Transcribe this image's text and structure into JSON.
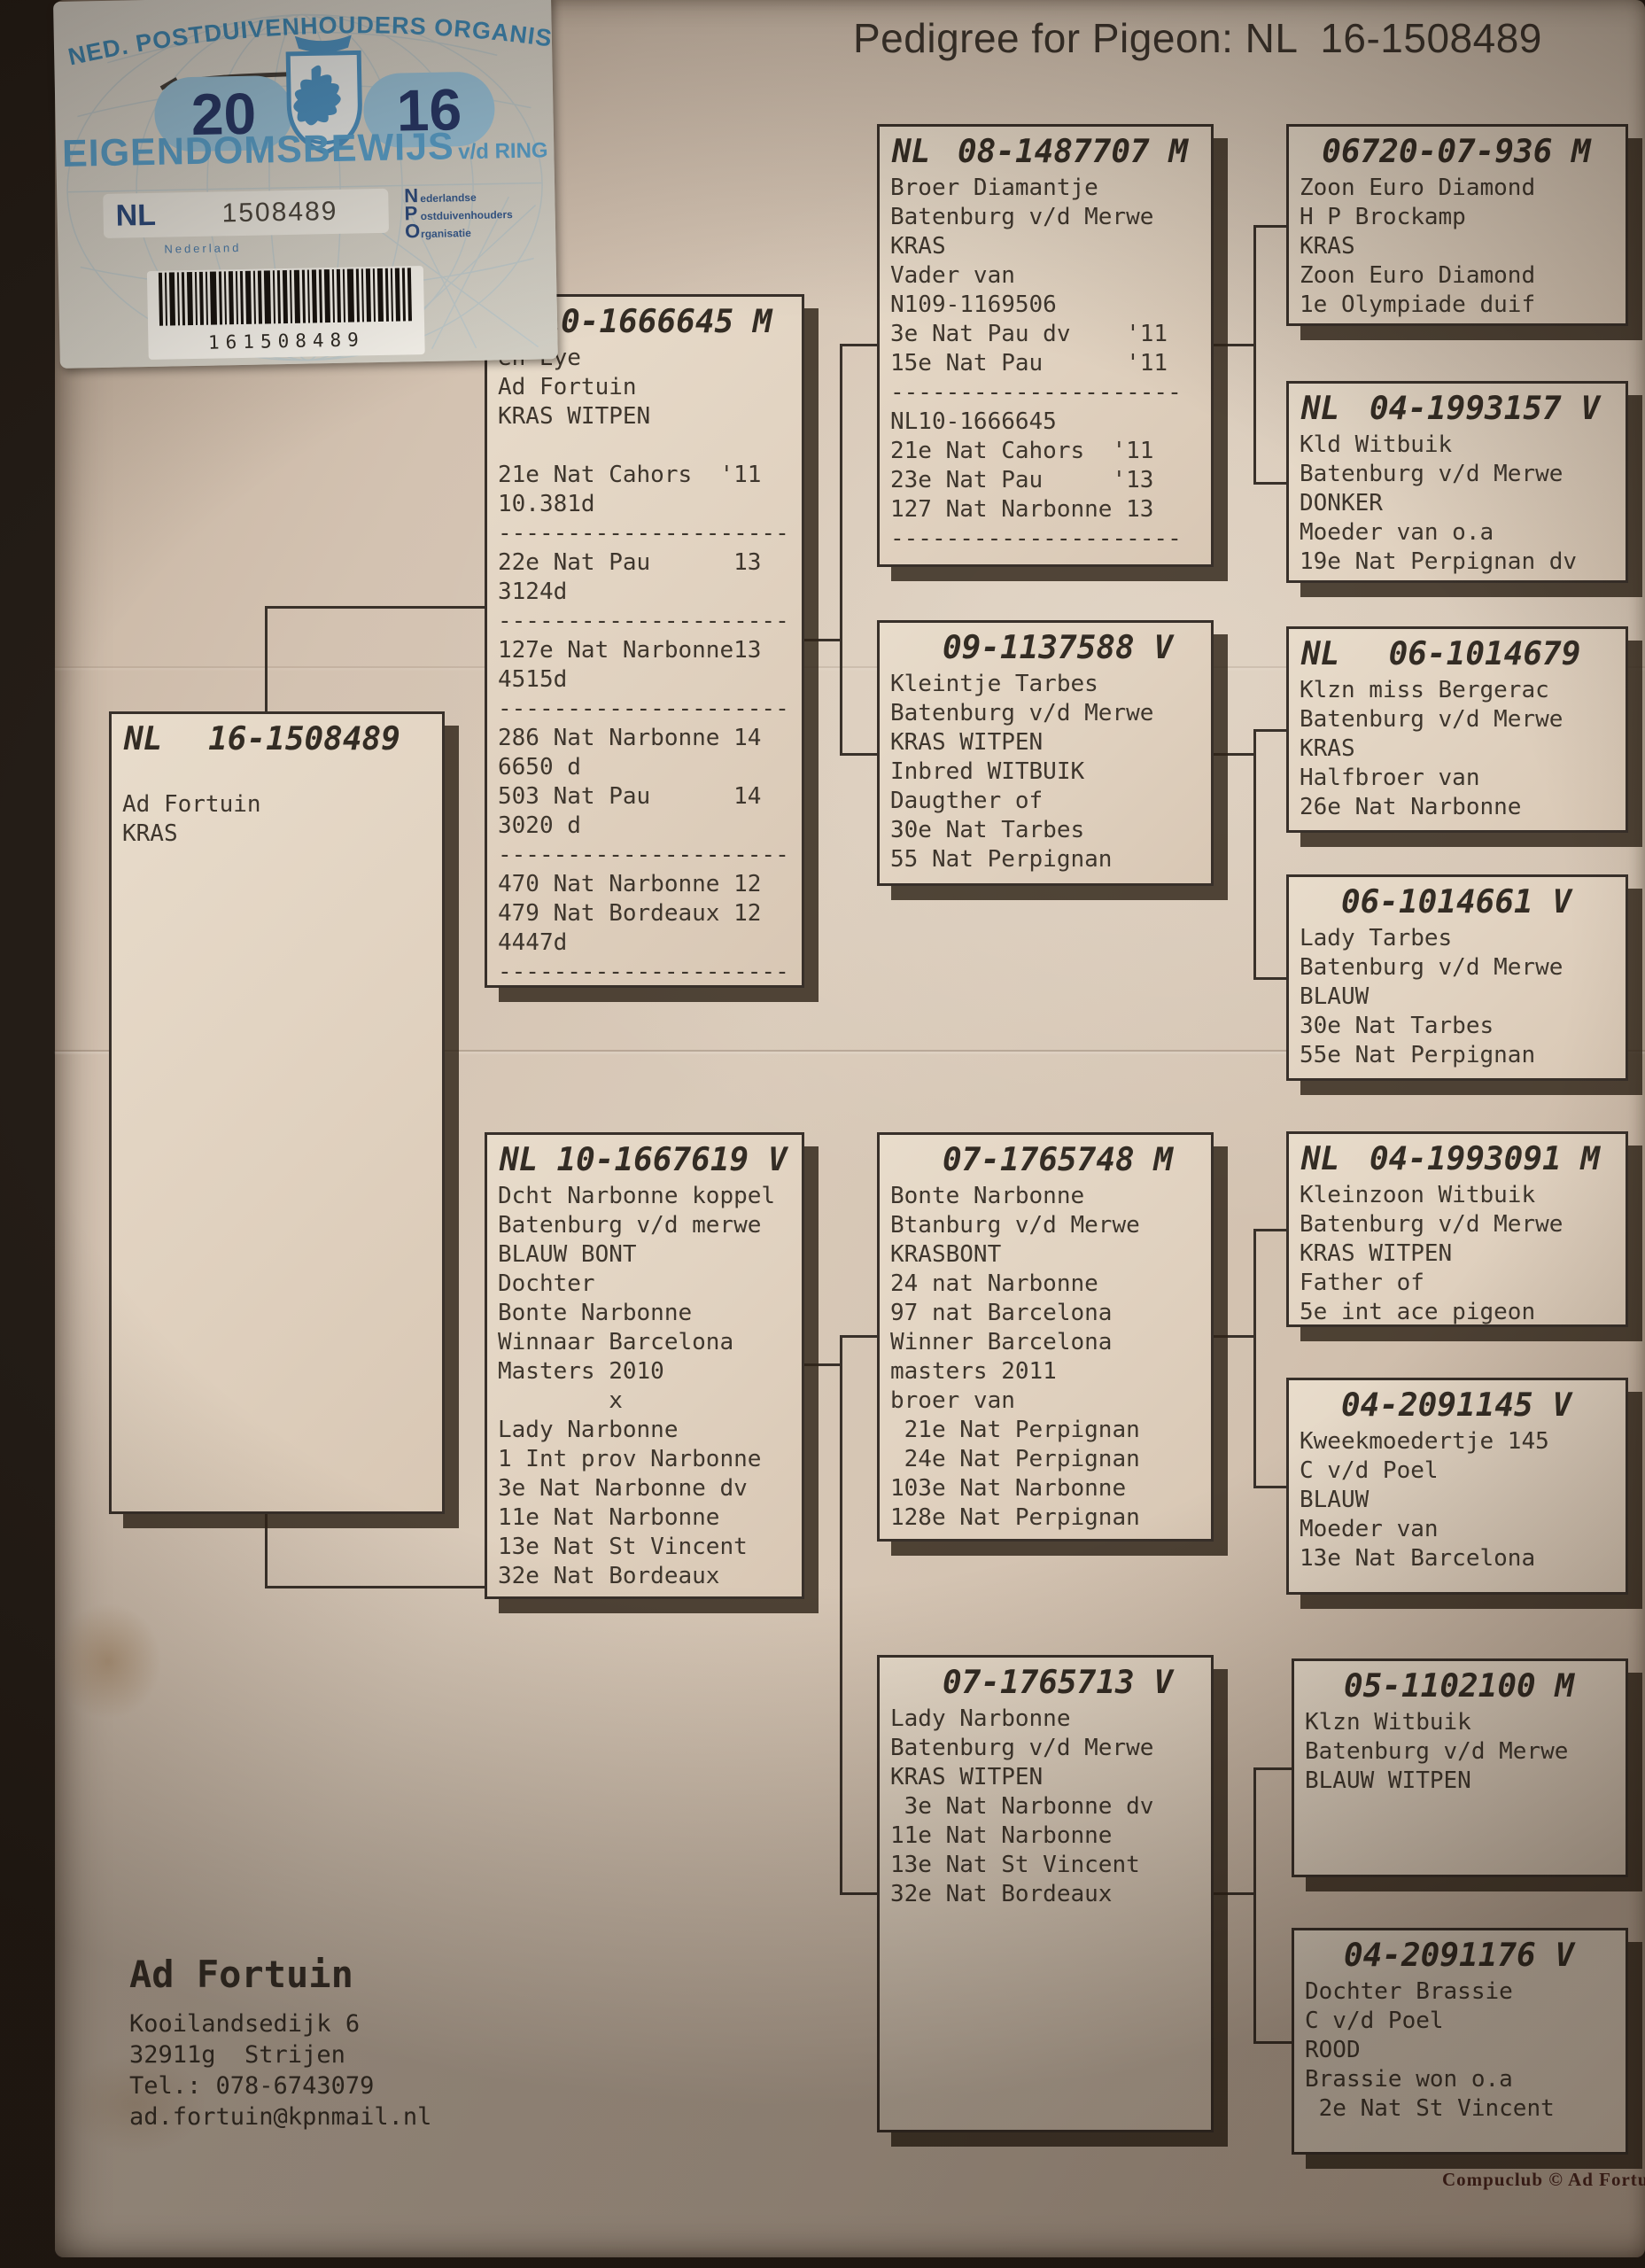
{
  "title": "Pedigree for Pigeon: NL  16-1508489",
  "sticker": {
    "org_arc": "NED. POSTDUIVENHOUDERS ORGANISATIE",
    "year_left": "20",
    "year_right": "16",
    "ownership_main": "EIGENDOMSBEWIJS",
    "ownership_suffix": "v/d RING",
    "country": "NL",
    "ring_number": "1508489",
    "npo_rows": [
      {
        "initial": "N",
        "rest": "ederlandse"
      },
      {
        "initial": "P",
        "rest": "ostduivenhouders"
      },
      {
        "initial": "O",
        "rest": "rganisatie"
      }
    ],
    "nederland_caption": "Nederland",
    "barcode_number": "161508489"
  },
  "pedigree": {
    "subject": {
      "prefix": "NL",
      "ring": "16-1508489",
      "body": "\nAd Fortuin\nKRAS"
    },
    "father": {
      "prefix": "",
      "ring": "10-1666645 M",
      "body": "en Eye\nAd Fortuin\nKRAS WITPEN\n\n21e Nat Cahors  '11\n10.381d\n---------------------\n22e Nat Pau      13\n3124d\n---------------------\n127e Nat Narbonne13\n4515d\n---------------------\n286 Nat Narbonne 14\n6650 d\n503 Nat Pau      14\n3020 d\n---------------------\n470 Nat Narbonne 12\n479 Nat Bordeaux 12\n4447d\n---------------------"
    },
    "mother": {
      "prefix": "NL",
      "ring": "10-1667619 V",
      "body": "Dcht Narbonne koppel\nBatenburg v/d merwe\nBLAUW BONT\nDochter\nBonte Narbonne\nWinnaar Barcelona\nMasters 2010\n        x\nLady Narbonne\n1 Int prov Narbonne\n3e Nat Narbonne dv\n11e Nat Narbonne\n13e Nat St Vincent\n32e Nat Bordeaux"
    },
    "ff": {
      "prefix": "NL",
      "ring": "08-1487707 M",
      "body": "Broer Diamantje\nBatenburg v/d Merwe\nKRAS\nVader van\nN109-1169506\n3e Nat Pau dv    '11\n15e Nat Pau      '11\n---------------------\nNL10-1666645\n21e Nat Cahors  '11\n23e Nat Pau     '13\n127 Nat Narbonne 13\n---------------------"
    },
    "fm": {
      "prefix": "",
      "ring": "09-1137588 V",
      "body": "Kleintje Tarbes\nBatenburg v/d Merwe\nKRAS WITPEN\nInbred WITBUIK\nDaugther of\n30e Nat Tarbes\n55 Nat Perpignan"
    },
    "mf": {
      "prefix": "",
      "ring": "07-1765748 M",
      "body": "Bonte Narbonne\nBtanburg v/d Merwe\nKRASBONT\n24 nat Narbonne\n97 nat Barcelona\nWinner Barcelona\nmasters 2011\nbroer van\n 21e Nat Perpignan\n 24e Nat Perpignan\n103e Nat Narbonne\n128e Nat Perpignan"
    },
    "mm": {
      "prefix": "",
      "ring": "07-1765713 V",
      "body": "Lady Narbonne\nBatenburg v/d Merwe\nKRAS WITPEN\n 3e Nat Narbonne dv\n11e Nat Narbonne\n13e Nat St Vincent\n32e Nat Bordeaux"
    },
    "fff": {
      "prefix": "",
      "ring": "06720-07-936 M",
      "body": "Zoon Euro Diamond\nH P Brockamp\nKRAS\nZoon Euro Diamond\n1e Olympiade duif"
    },
    "ffm": {
      "prefix": "NL",
      "ring": "04-1993157 V",
      "body": "Kld Witbuik\nBatenburg v/d Merwe\nDONKER\nMoeder van o.a\n19e Nat Perpignan dv"
    },
    "fmf": {
      "prefix": "NL",
      "ring": "06-1014679",
      "body": "Klzn miss Bergerac\nBatenburg v/d Merwe\nKRAS\nHalfbroer van\n26e Nat Narbonne"
    },
    "fmm": {
      "prefix": "",
      "ring": "06-1014661 V",
      "body": "Lady Tarbes\nBatenburg v/d Merwe\nBLAUW\n30e Nat Tarbes\n55e Nat Perpignan"
    },
    "mff": {
      "prefix": "NL",
      "ring": "04-1993091 M",
      "body": "Kleinzoon Witbuik\nBatenburg v/d Merwe\nKRAS WITPEN\nFather of\n5e int ace pigeon"
    },
    "mfm": {
      "prefix": "",
      "ring": "04-2091145 V",
      "body": "Kweekmoedertje 145\nC v/d Poel\nBLAUW\nMoeder van\n13e Nat Barcelona"
    },
    "mmf": {
      "prefix": "",
      "ring": "05-1102100 M",
      "body": "Klzn Witbuik\nBatenburg v/d Merwe\nBLAUW WITPEN"
    },
    "mmm": {
      "prefix": "",
      "ring": "04-2091176 V",
      "body": "Dochter Brassie\nC v/d Poel\nROOD\nBrassie won o.a\n 2e Nat St Vincent"
    }
  },
  "contact": {
    "name": "Ad Fortuin",
    "lines": "Kooilandsedijk 6\n32911g  Strijen\nTel.: 078-6743079\nad.fortuin@kpnmail.nl"
  },
  "footer_credit": "Compuclub © Ad Fortu",
  "colors": {
    "accent_blue": "#3f8cba",
    "navy": "#273869",
    "paper": "#d3c2b1",
    "ink": "#3e362d"
  }
}
